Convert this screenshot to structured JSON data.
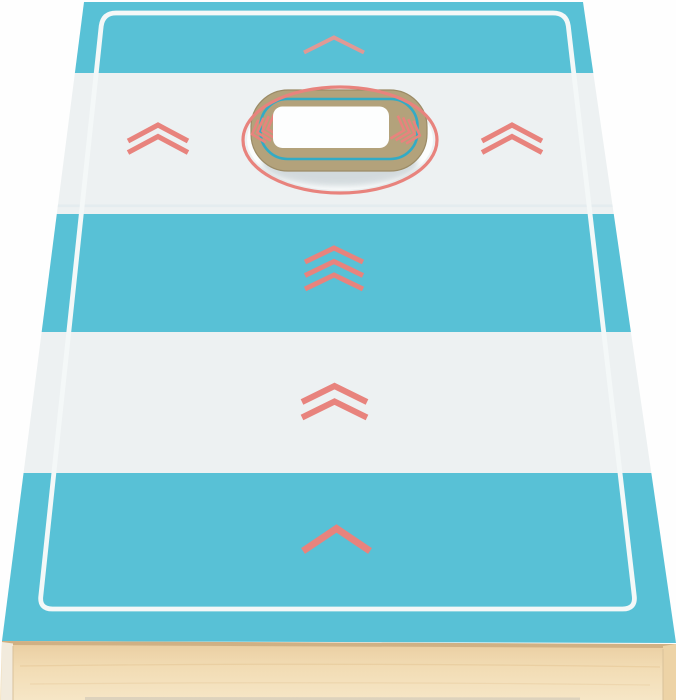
{
  "meta": {
    "type": "product-photo",
    "subject": "Cornhole bean-bag toss game board",
    "description": "Perspective product photo of a wooden cornhole (bean-bag toss) board with five alternating turquoise and white stripes, coral chevron arrows pointing up toward a round target hole, a thin white inset border line, and a natural birch wood frame visible along the front edge. Through the target hole the tan top of a second stacked board is visible with a teal rounded outline, small coral chevron accents and a white handle cutout."
  },
  "colors": {
    "background": "#fefefe",
    "teal": "#58c1d6",
    "stripe_white": "#edf1f2",
    "coral": "#e8837d",
    "coral_light": "#ef958e",
    "border_white": "#f4f8f8",
    "stripe_edge_highlight": "#dde9ec",
    "hole_backing_white": "#fbfdfd",
    "hole_shadow": "#c9d2d6",
    "hole_tan": "#b3a27b",
    "hole_tan_edge": "#9b8b66",
    "hole_teal_line": "#2bacc9",
    "hole_white_rect": "#fdfefe",
    "wood_top": "#e9cda0",
    "wood_mid": "#f2dcb4",
    "wood_bottom": "#f6e6c6",
    "wood_top_shadow": "#b18c60",
    "wood_side_left": "#f2ebdd",
    "wood_side_right": "#edd3a6",
    "wood_seam": "#d9c29a",
    "wood_grain": "#e3c392",
    "ground_shadow": "#c9c3b6"
  },
  "board": {
    "stripe_count": 5,
    "stripes": [
      {
        "position": "top",
        "color_name": "turquoise",
        "marker": "single thin chevron-up"
      },
      {
        "position": "upper",
        "color_name": "white",
        "marker": "target hole flanked by double chevrons"
      },
      {
        "position": "middle",
        "color_name": "turquoise",
        "marker": "triple chevron-up"
      },
      {
        "position": "lower",
        "color_name": "white",
        "marker": "double chevron-up"
      },
      {
        "position": "bottom",
        "color_name": "turquoise",
        "marker": "single bold chevron-up"
      }
    ],
    "border": "thin white inset outline with rounded corners",
    "hole": {
      "ring": "coral ellipse outline",
      "through_hole": "tan lower board with teal rounded outline, coral chevron accents, white handle cutout and soft shadow"
    },
    "frame": "natural birch wood front edge"
  }
}
